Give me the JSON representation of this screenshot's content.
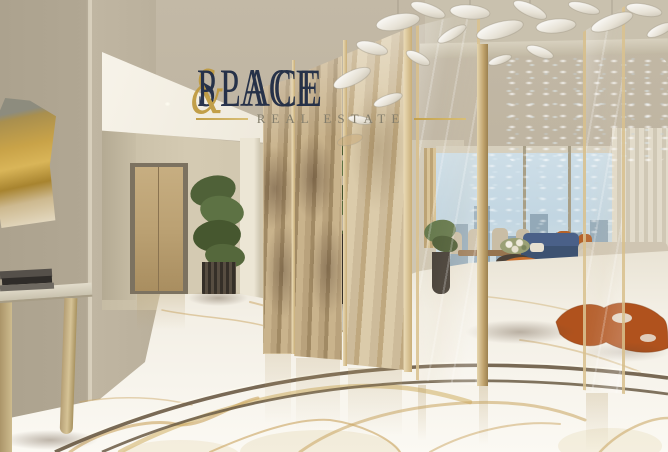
{
  "watermark": {
    "line1": {
      "left": "SPACE",
      "ampersand": "&",
      "right": "PLACE"
    },
    "line2": "REAL ESTATE",
    "colors": {
      "text": "#1b2843",
      "accent": "#bf9a3e",
      "subtext": "#837d6b"
    }
  },
  "scene": {
    "type": "luxury-penthouse-interior-rendering",
    "elements": [
      "textured-plaster-walls",
      "abstract-gold-wall-art",
      "console-table-with-books",
      "hallway-with-gold-elevator-doors",
      "potted-dracaena-plant",
      "antique-mirror-gold-divider-panels",
      "glass-partition-panels",
      "glass-leaf-ceiling-chandelier",
      "cascading-crystal-chandelier",
      "floor-to-ceiling-windows-city-view",
      "sheer-curtains",
      "navy-sofa",
      "burnt-orange-barrel-chair",
      "cream-chaise-sofa",
      "dining-table-with-chairs",
      "orange-cowhide-rug",
      "white-marble-floor-gold-veining",
      "bronze-floor-inlay-strips"
    ],
    "palette": {
      "wall_texture": "#b3a996",
      "ceiling": "#c9c1ae",
      "hallway_wall": "#cfc5ad",
      "gold_door": "#bba173",
      "panel_champagne": "#c3ae89",
      "marble_floor": "#f3efe6",
      "marble_vein": "#c9a45f",
      "inlay_strip": "#6a5a44",
      "sky": "#c2d6e2",
      "city_buildings": "#93a9b8",
      "sofa_navy": "#46608a",
      "chair_orange": "#b2571f",
      "sofa_cream": "#cfc5b2",
      "plant_green": "#4f6138",
      "planter_dark": "#3e3831",
      "curtain": "#dcd5c4"
    }
  }
}
